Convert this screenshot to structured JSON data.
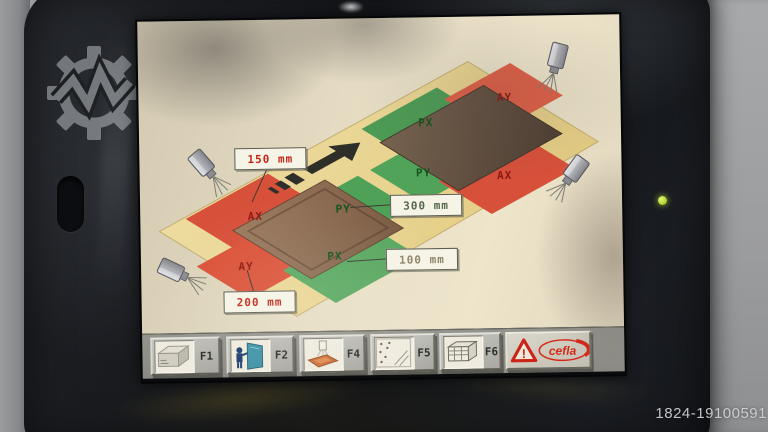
{
  "photo": {
    "listing_id": "1824-19100591"
  },
  "colors": {
    "conveyor_yellow": "#ecd795",
    "zone_red": "#d7503a",
    "zone_green": "#4fa158",
    "panel_brown": "#8d6e55",
    "led_green": "#b5e332",
    "brand_red": "#d42a1a"
  },
  "screen": {
    "zones": {
      "infeed": {
        "ax": "AX",
        "py": "PY",
        "ay": "AY",
        "px": "PX"
      },
      "outfeed": {
        "px": "PX",
        "ay": "AY",
        "py": "PY",
        "ax": "AX"
      }
    },
    "measurements": [
      {
        "name": "ax-offset",
        "value": "150 mm"
      },
      {
        "name": "py-offset",
        "value": "300 mm"
      },
      {
        "name": "px-offset",
        "value": "100 mm"
      },
      {
        "name": "ay-offset",
        "value": "200 mm"
      }
    ],
    "toolbar": {
      "buttons": [
        {
          "label": "F1",
          "icon": "machine-module-icon"
        },
        {
          "label": "F2",
          "icon": "operator-panel-icon"
        },
        {
          "label": "F4",
          "icon": "spray-coating-icon"
        },
        {
          "label": "F5",
          "icon": "spray-pattern-icon"
        },
        {
          "label": "F6",
          "icon": "dryer-rack-icon"
        }
      ],
      "brand": {
        "name": "cefla",
        "warning_mark": "!"
      }
    }
  }
}
